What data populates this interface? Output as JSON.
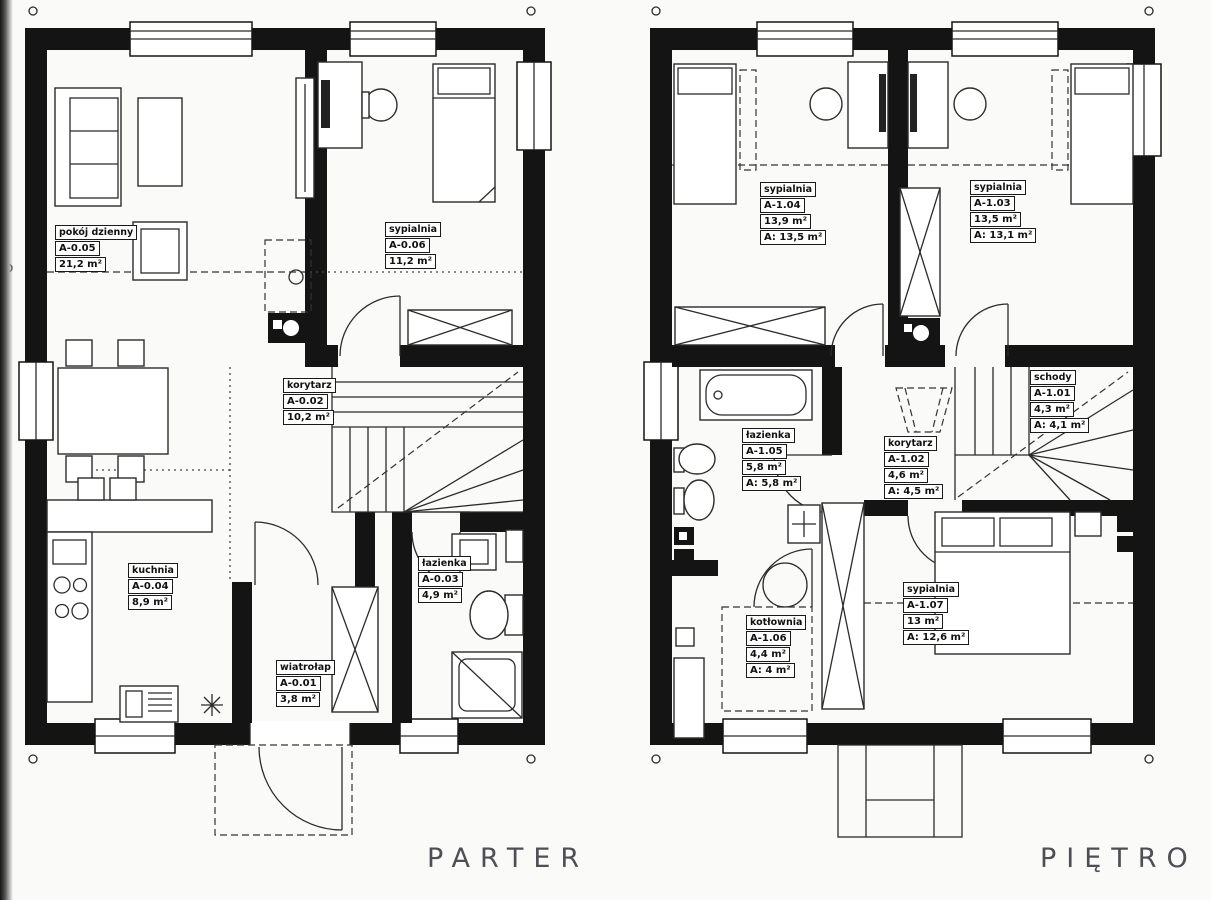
{
  "floors": {
    "parter": {
      "title": "PARTER",
      "rooms": [
        {
          "name": "pokój dzienny",
          "id": "A-0.05",
          "area": "21,2 m²"
        },
        {
          "name": "sypialnia",
          "id": "A-0.06",
          "area": "11,2 m²"
        },
        {
          "name": "korytarz",
          "id": "A-0.02",
          "area": "10,2 m²"
        },
        {
          "name": "kuchnia",
          "id": "A-0.04",
          "area": "8,9 m²"
        },
        {
          "name": "łazienka",
          "id": "A-0.03",
          "area": "4,9 m²"
        },
        {
          "name": "wiatrołap",
          "id": "A-0.01",
          "area": "3,8 m²"
        }
      ]
    },
    "pietro": {
      "title": "PIĘTRO",
      "rooms": [
        {
          "name": "sypialnia",
          "id": "A-1.04",
          "area": "13,9 m²",
          "area2": "A: 13,5 m²"
        },
        {
          "name": "sypialnia",
          "id": "A-1.03",
          "area": "13,5 m²",
          "area2": "A: 13,1 m²"
        },
        {
          "name": "łazienka",
          "id": "A-1.05",
          "area": "5,8 m²",
          "area2": "A: 5,8 m²"
        },
        {
          "name": "korytarz",
          "id": "A-1.02",
          "area": "4,6 m²",
          "area2": "A: 4,5 m²"
        },
        {
          "name": "schody",
          "id": "A-1.01",
          "area": "4,3 m²",
          "area2": "A: 4,1 m²"
        },
        {
          "name": "kotłownia",
          "id": "A-1.06",
          "area": "4,4 m²",
          "area2": "A: 4 m²"
        },
        {
          "name": "sypialnia",
          "id": "A-1.07",
          "area": "13 m²",
          "area2": "A: 12,6 m²"
        }
      ]
    }
  },
  "colors": {
    "wall": "#141414",
    "line": "#2b2b2b",
    "title": "#4e4e54",
    "background": "#fafaf8"
  }
}
